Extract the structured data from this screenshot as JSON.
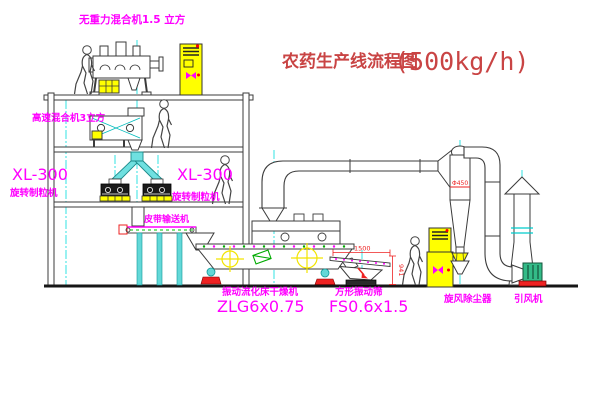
{
  "title": {
    "name": "农药生产线流程图",
    "capacity": "(500kg/h)"
  },
  "labels": {
    "gravity_mixer": "无重力混合机1.5 立方",
    "high_speed_mixer": "高速混合机3立方",
    "granulator_left_model": "XL-300",
    "granulator_left_name": "旋转制粒机",
    "granulator_right_model": "XL-300",
    "granulator_right_name": "旋转制粒机",
    "belt_conveyor": "皮带输送机",
    "dryer_name": "振动流化床干燥机",
    "dryer_model": "ZLG6x0.75",
    "screen_name": "方形振动筛",
    "screen_model": "FS0.6x1.5",
    "cyclone": "旋风除尘器",
    "fan": "引风机"
  },
  "dimensions": {
    "cyclone_dia": "Φ450",
    "screen_length": "1500",
    "screen_height": "941"
  },
  "colors": {
    "label_magenta": "#ff00ff",
    "title_red": "#c94444",
    "line_dark": "#3b3b3b",
    "centerline_cyan": "#00e0e0",
    "equipment_yellow": "#ffff00",
    "alert_red": "#ee2222",
    "bolt_green": "#00aa00"
  }
}
